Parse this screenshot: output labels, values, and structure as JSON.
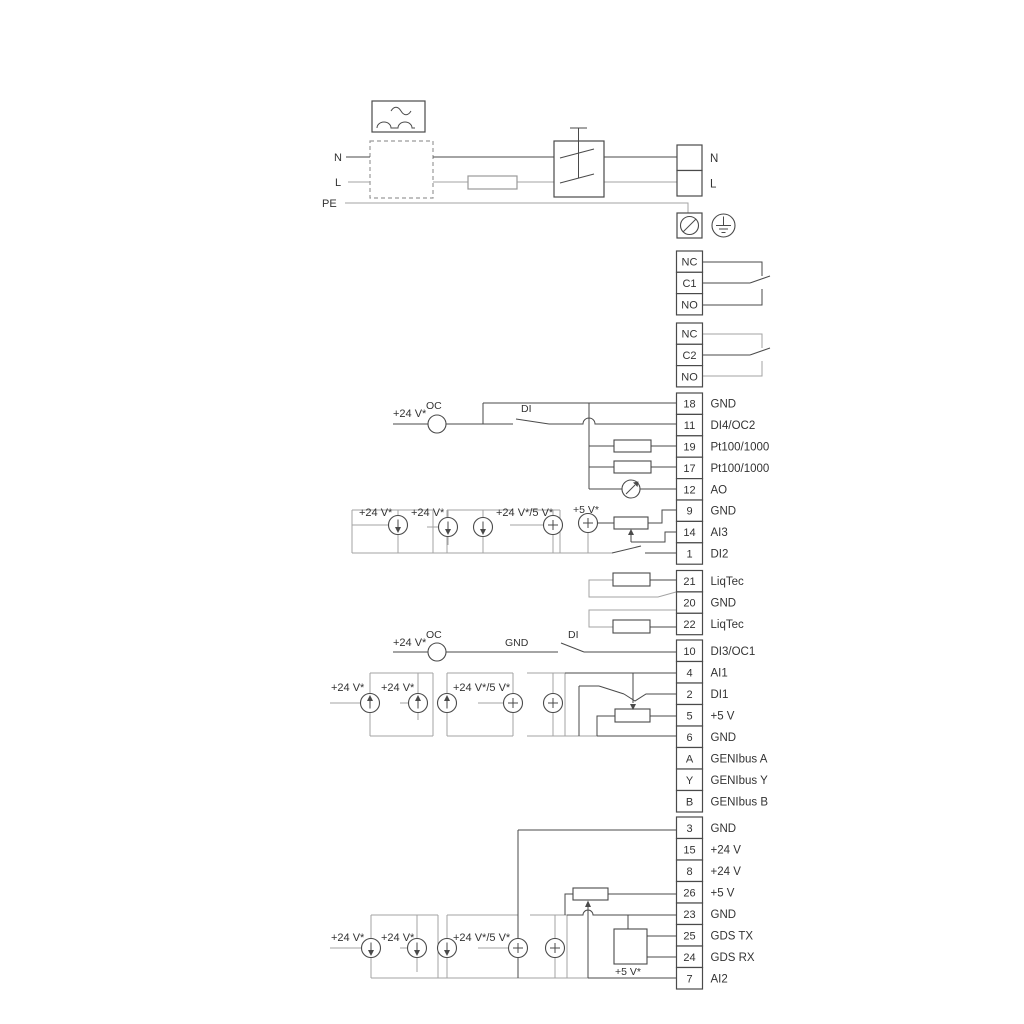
{
  "title": "Pump wiring diagram",
  "colors": {
    "line_dark": "#4a4a4a",
    "line_gray": "#a3a3a3",
    "text": "#333333",
    "background": "#ffffff"
  },
  "labels": {
    "n": "N",
    "l": "L",
    "pe": "PE",
    "oc": "OC",
    "di": "DI",
    "gnd": "GND",
    "v24": "+24 V*",
    "v24_5": "+24 V*/5 V*",
    "v5": "+5 V*"
  },
  "terminal_groups": [
    {
      "name": "mains",
      "x": 677,
      "w": 25,
      "y": 145,
      "cell_h": 25.5,
      "cells": [
        {
          "num": "",
          "label": "N"
        },
        {
          "num": "",
          "label": "L"
        }
      ]
    },
    {
      "name": "relay1",
      "x": 676.5,
      "w": 26,
      "y": 251,
      "cell_h": 21.3,
      "cells": [
        {
          "num": "NC",
          "label": ""
        },
        {
          "num": "C1",
          "label": ""
        },
        {
          "num": "NO",
          "label": ""
        }
      ]
    },
    {
      "name": "relay2",
      "x": 676.5,
      "w": 26,
      "y": 323,
      "cell_h": 21.3,
      "cells": [
        {
          "num": "NC",
          "label": ""
        },
        {
          "num": "C2",
          "label": ""
        },
        {
          "num": "NO",
          "label": ""
        }
      ]
    },
    {
      "name": "io1",
      "x": 676.5,
      "w": 26,
      "y": 393,
      "cell_h": 21.4,
      "cells": [
        {
          "num": "18",
          "label": "GND"
        },
        {
          "num": "11",
          "label": "DI4/OC2"
        },
        {
          "num": "19",
          "label": "Pt100/1000"
        },
        {
          "num": "17",
          "label": "Pt100/1000"
        },
        {
          "num": "12",
          "label": "AO"
        },
        {
          "num": "9",
          "label": "GND"
        },
        {
          "num": "14",
          "label": "AI3"
        },
        {
          "num": "1",
          "label": "DI2"
        }
      ]
    },
    {
      "name": "liqtec",
      "x": 676.5,
      "w": 26,
      "y": 570.5,
      "cell_h": 21.4,
      "cells": [
        {
          "num": "21",
          "label": "LiqTec"
        },
        {
          "num": "20",
          "label": "GND"
        },
        {
          "num": "22",
          "label": "LiqTec"
        }
      ]
    },
    {
      "name": "io2",
      "x": 676.5,
      "w": 26,
      "y": 640,
      "cell_h": 21.5,
      "cells": [
        {
          "num": "10",
          "label": "DI3/OC1"
        },
        {
          "num": "4",
          "label": "AI1"
        },
        {
          "num": "2",
          "label": "DI1"
        },
        {
          "num": "5",
          "label": "+5 V"
        },
        {
          "num": "6",
          "label": "GND"
        },
        {
          "num": "A",
          "label": "GENIbus A"
        },
        {
          "num": "Y",
          "label": "GENIbus Y"
        },
        {
          "num": "B",
          "label": "GENIbus B"
        }
      ]
    },
    {
      "name": "io3",
      "x": 676.5,
      "w": 26,
      "y": 817,
      "cell_h": 21.5,
      "cells": [
        {
          "num": "3",
          "label": "GND"
        },
        {
          "num": "15",
          "label": "+24 V"
        },
        {
          "num": "8",
          "label": "+24 V"
        },
        {
          "num": "26",
          "label": "+5 V"
        },
        {
          "num": "23",
          "label": "GND"
        },
        {
          "num": "25",
          "label": "GDS TX"
        },
        {
          "num": "24",
          "label": "GDS RX"
        },
        {
          "num": "7",
          "label": "AI2"
        }
      ]
    }
  ]
}
